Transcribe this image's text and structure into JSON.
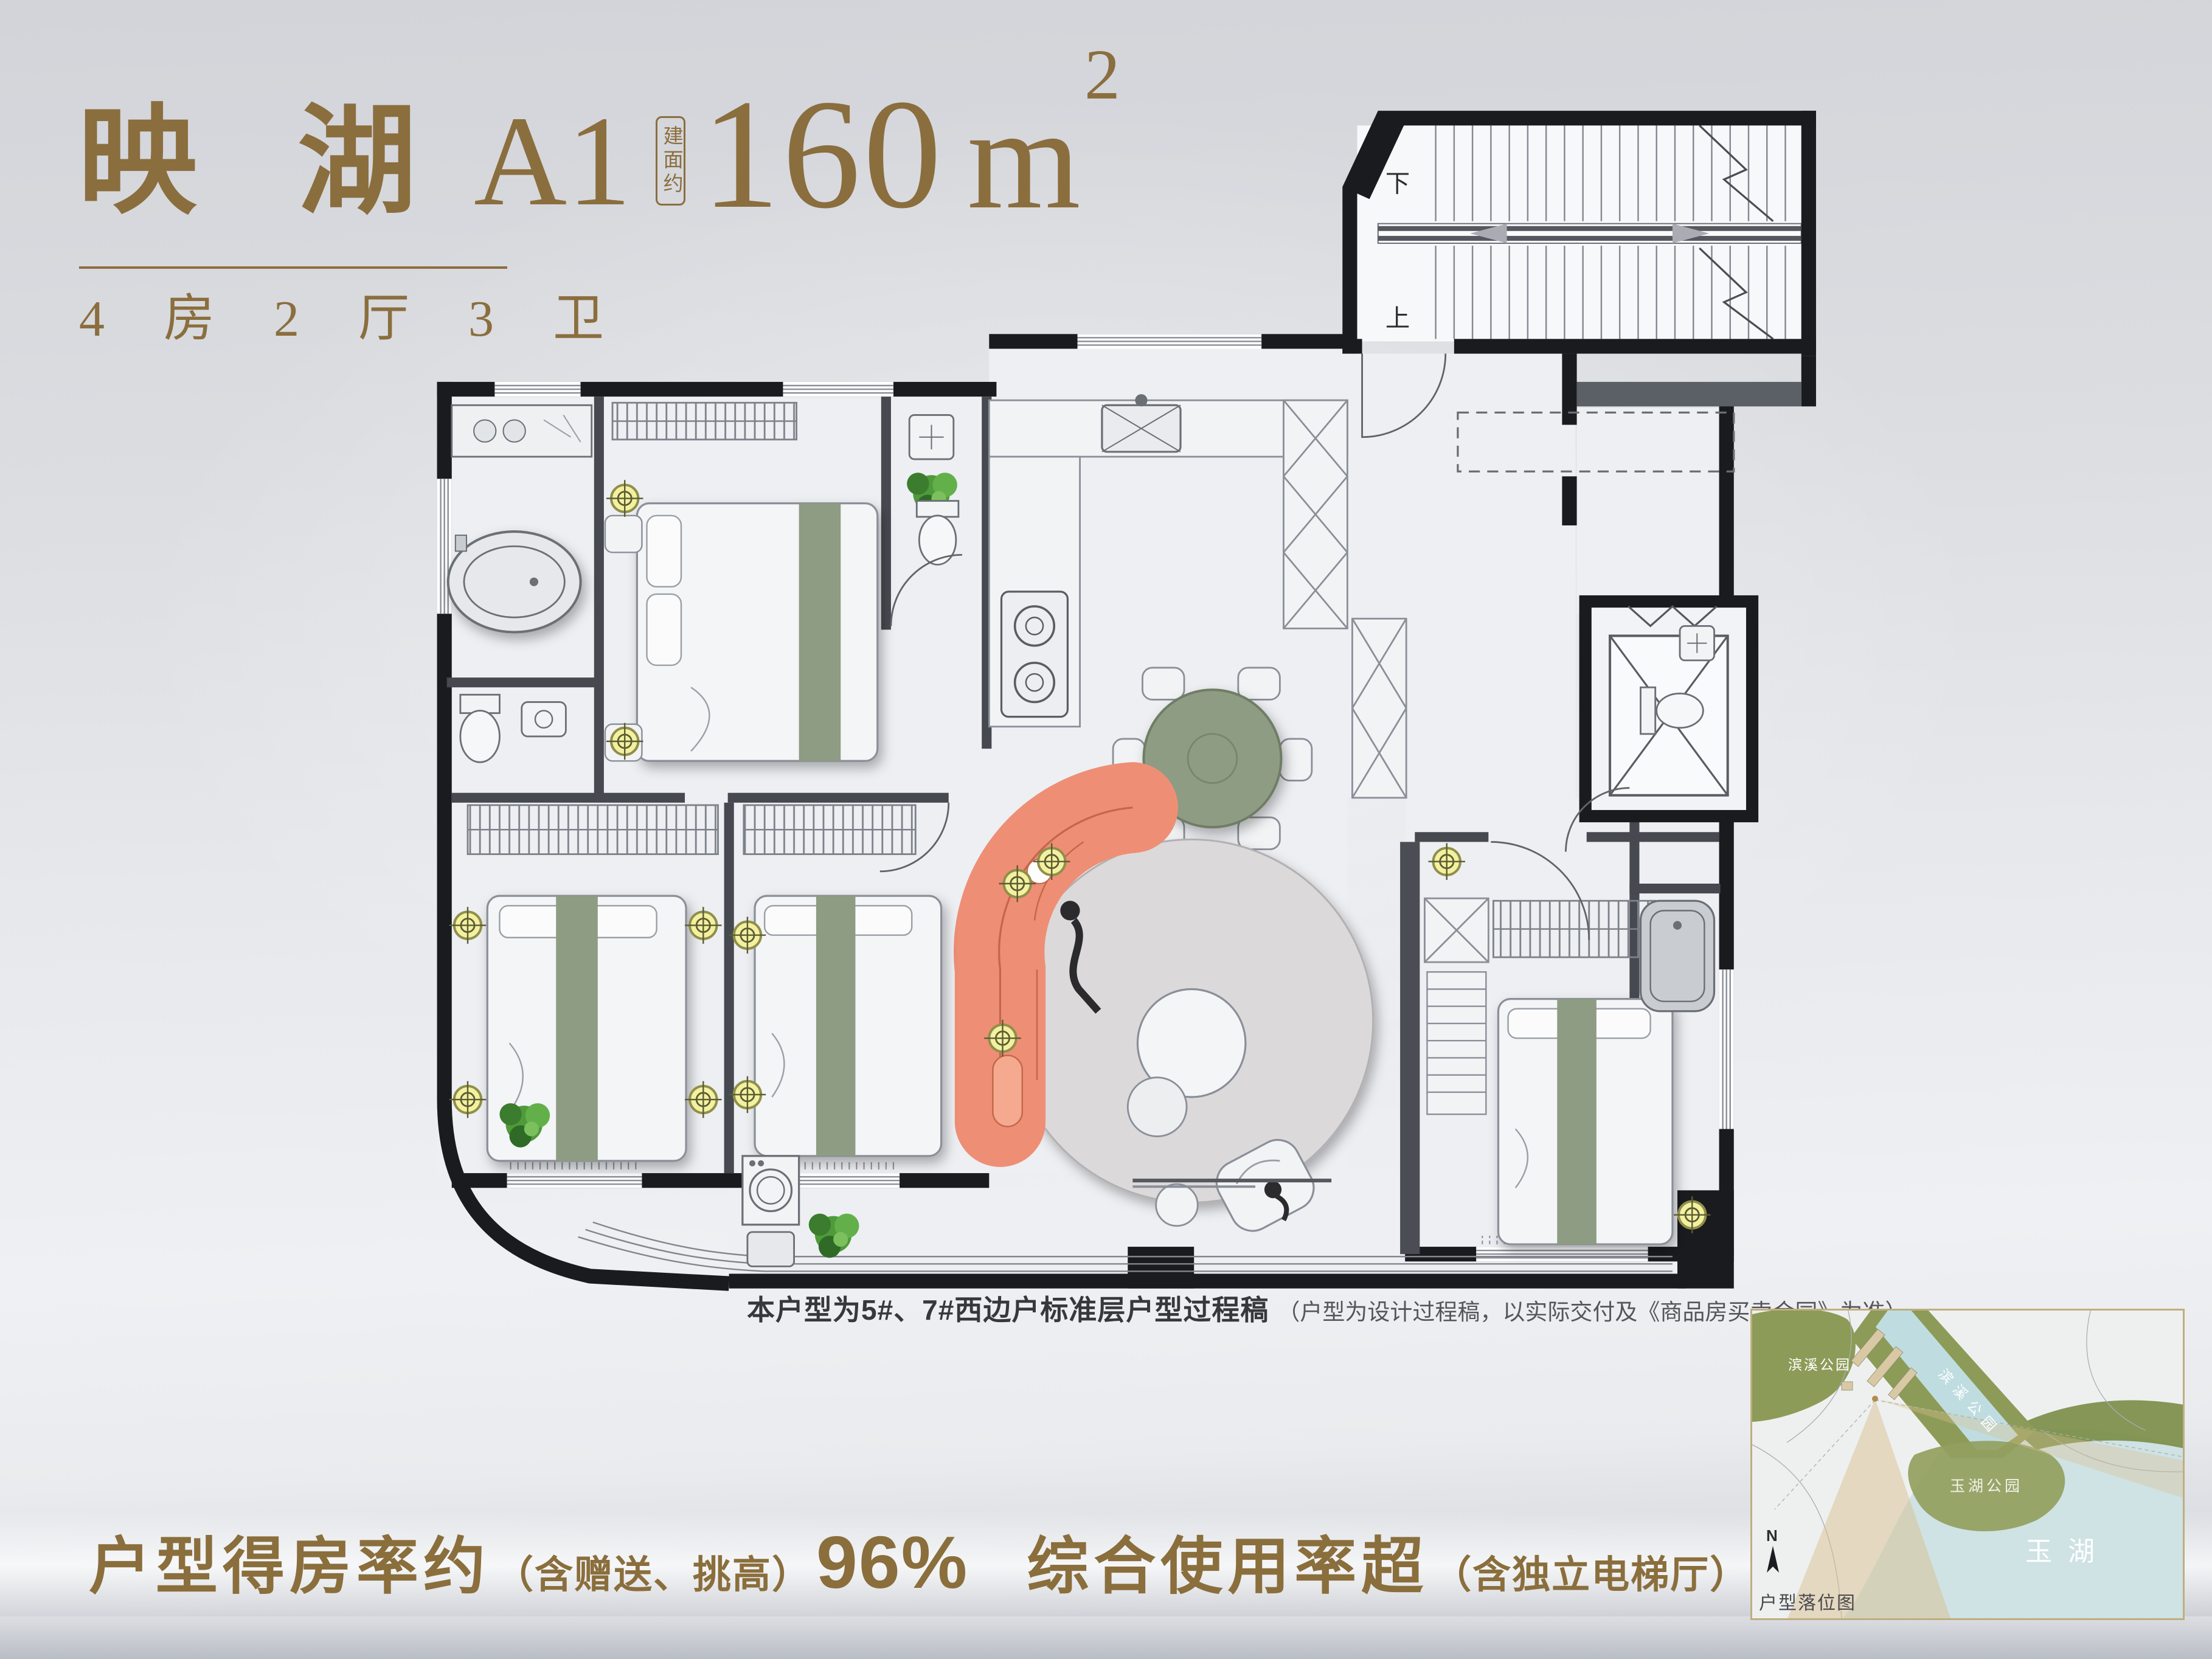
{
  "header": {
    "project_name": "映 湖",
    "unit_code": "A1",
    "area_label": "建面约",
    "area_value": "160",
    "area_unit": "m",
    "area_sup": "2",
    "rooms_line": "4 房 2 厅 3 卫"
  },
  "plan": {
    "stair_up": "上",
    "stair_down": "下"
  },
  "caption": {
    "main": "本户型为5#、7#西边户标准层户型过程稿",
    "note": "（户型为设计过程稿，以实际交付及《商品房买卖合同》为准）"
  },
  "stats": {
    "item1_label": "户型得房率约",
    "item1_note": "（含赠送、挑高）",
    "item1_value": "96%",
    "item2_label": "综合使用率超",
    "item2_note": "（含独立电梯厅）",
    "item2_value": "100%"
  },
  "map": {
    "park_top": "滨溪公园",
    "park_diag": "滨溪公园",
    "park_mid": "玉湖公园",
    "lake": "玉湖",
    "compass_n": "N",
    "caption": "户型落位图"
  },
  "colors": {
    "gold": "#8a6e3c",
    "wall_black": "#1a1b1f",
    "sofa_coral": "#ee8f75",
    "table_green": "#8d9c83",
    "rug_gray": "#dcd9da",
    "water_blue": "#cfe2e4",
    "park_green": "#8c9b57",
    "spot_yellow": "#f3f1a0"
  }
}
